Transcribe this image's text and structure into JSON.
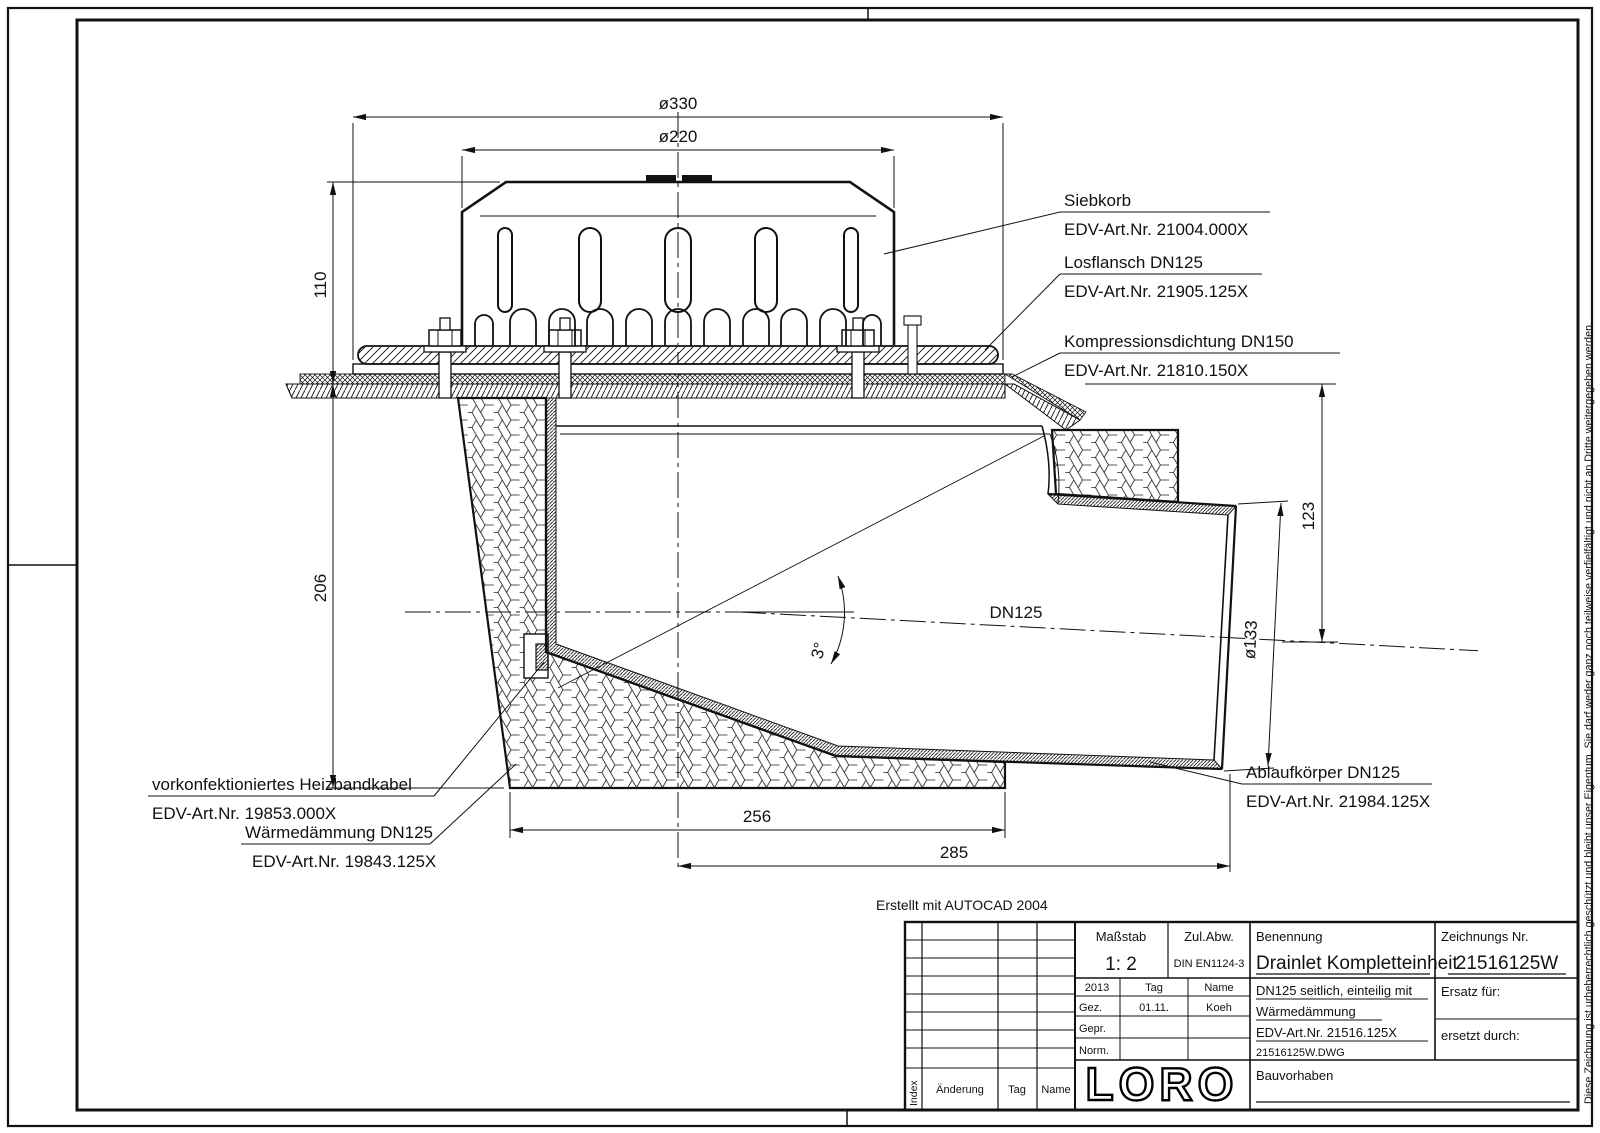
{
  "frame": {
    "note_top": "Erstellt mit AUTOCAD 2004",
    "copyright": "Diese Zeichnung ist urheberrechtlich geschützt und bleibt unser Eigentum. Sie darf weder ganz noch teilweise verfielfältigt und nicht an Dritte weitergegeben werden."
  },
  "dimensions": {
    "d330": "ø330",
    "d220": "ø220",
    "h110": "110",
    "h206": "206",
    "h123": "123",
    "d133": "ø133",
    "w256": "256",
    "w285": "285",
    "pipe": "DN125",
    "angle": "3°"
  },
  "labels": {
    "siebkorb": {
      "name": "Siebkorb",
      "edv": "EDV-Art.Nr.  21004.000X"
    },
    "losflansch": {
      "name": "Losflansch  DN125",
      "edv": "EDV-Art.Nr.  21905.125X"
    },
    "dichtung": {
      "name": "Kompressionsdichtung  DN150",
      "edv": "EDV-Art.Nr.  21810.150X"
    },
    "ablauf": {
      "name": "Ablaufkörper  DN125",
      "edv": "EDV-Art.Nr.  21984.125X"
    },
    "heizband": {
      "name": "vorkonfektioniertes  Heizbandkabel",
      "edv": "EDV-Art.Nr.  19853.000X"
    },
    "daemmung": {
      "name": "Wärmedämmung  DN125",
      "edv": "EDV-Art.Nr.  19843.125X"
    }
  },
  "titleblock": {
    "masstab_label": "Maßstab",
    "masstab_value": "1: 2",
    "zulabw_label": "Zul.Abw.",
    "zulabw_value": "DIN EN1124-3",
    "benennung_label": "Benennung",
    "benennung_value": "Drainlet Kompletteinheit",
    "zeichnung_label": "Zeichnungs Nr.",
    "zeichnung_value": "21516125W",
    "year": "2013",
    "tag_label": "Tag",
    "name_label": "Name",
    "gez_label": "Gez.",
    "gez_tag": "01.11.",
    "gez_name": "Koeh",
    "gepr_label": "Gepr.",
    "norm_label": "Norm.",
    "desc_line1": "DN125 seitlich, einteilig mit",
    "desc_line2": "Wärmedämmung",
    "desc_line3": "EDV-Art.Nr.  21516.125X",
    "desc_line4": "21516125W.DWG",
    "ersatz_label": "Ersatz für:",
    "ersetzt_label": "ersetzt durch:",
    "bauvorhaben_label": "Bauvorhaben",
    "logo": "LORO",
    "rev_index": "Index",
    "rev_aenderung": "Änderung",
    "rev_tag": "Tag",
    "rev_name": "Name"
  }
}
